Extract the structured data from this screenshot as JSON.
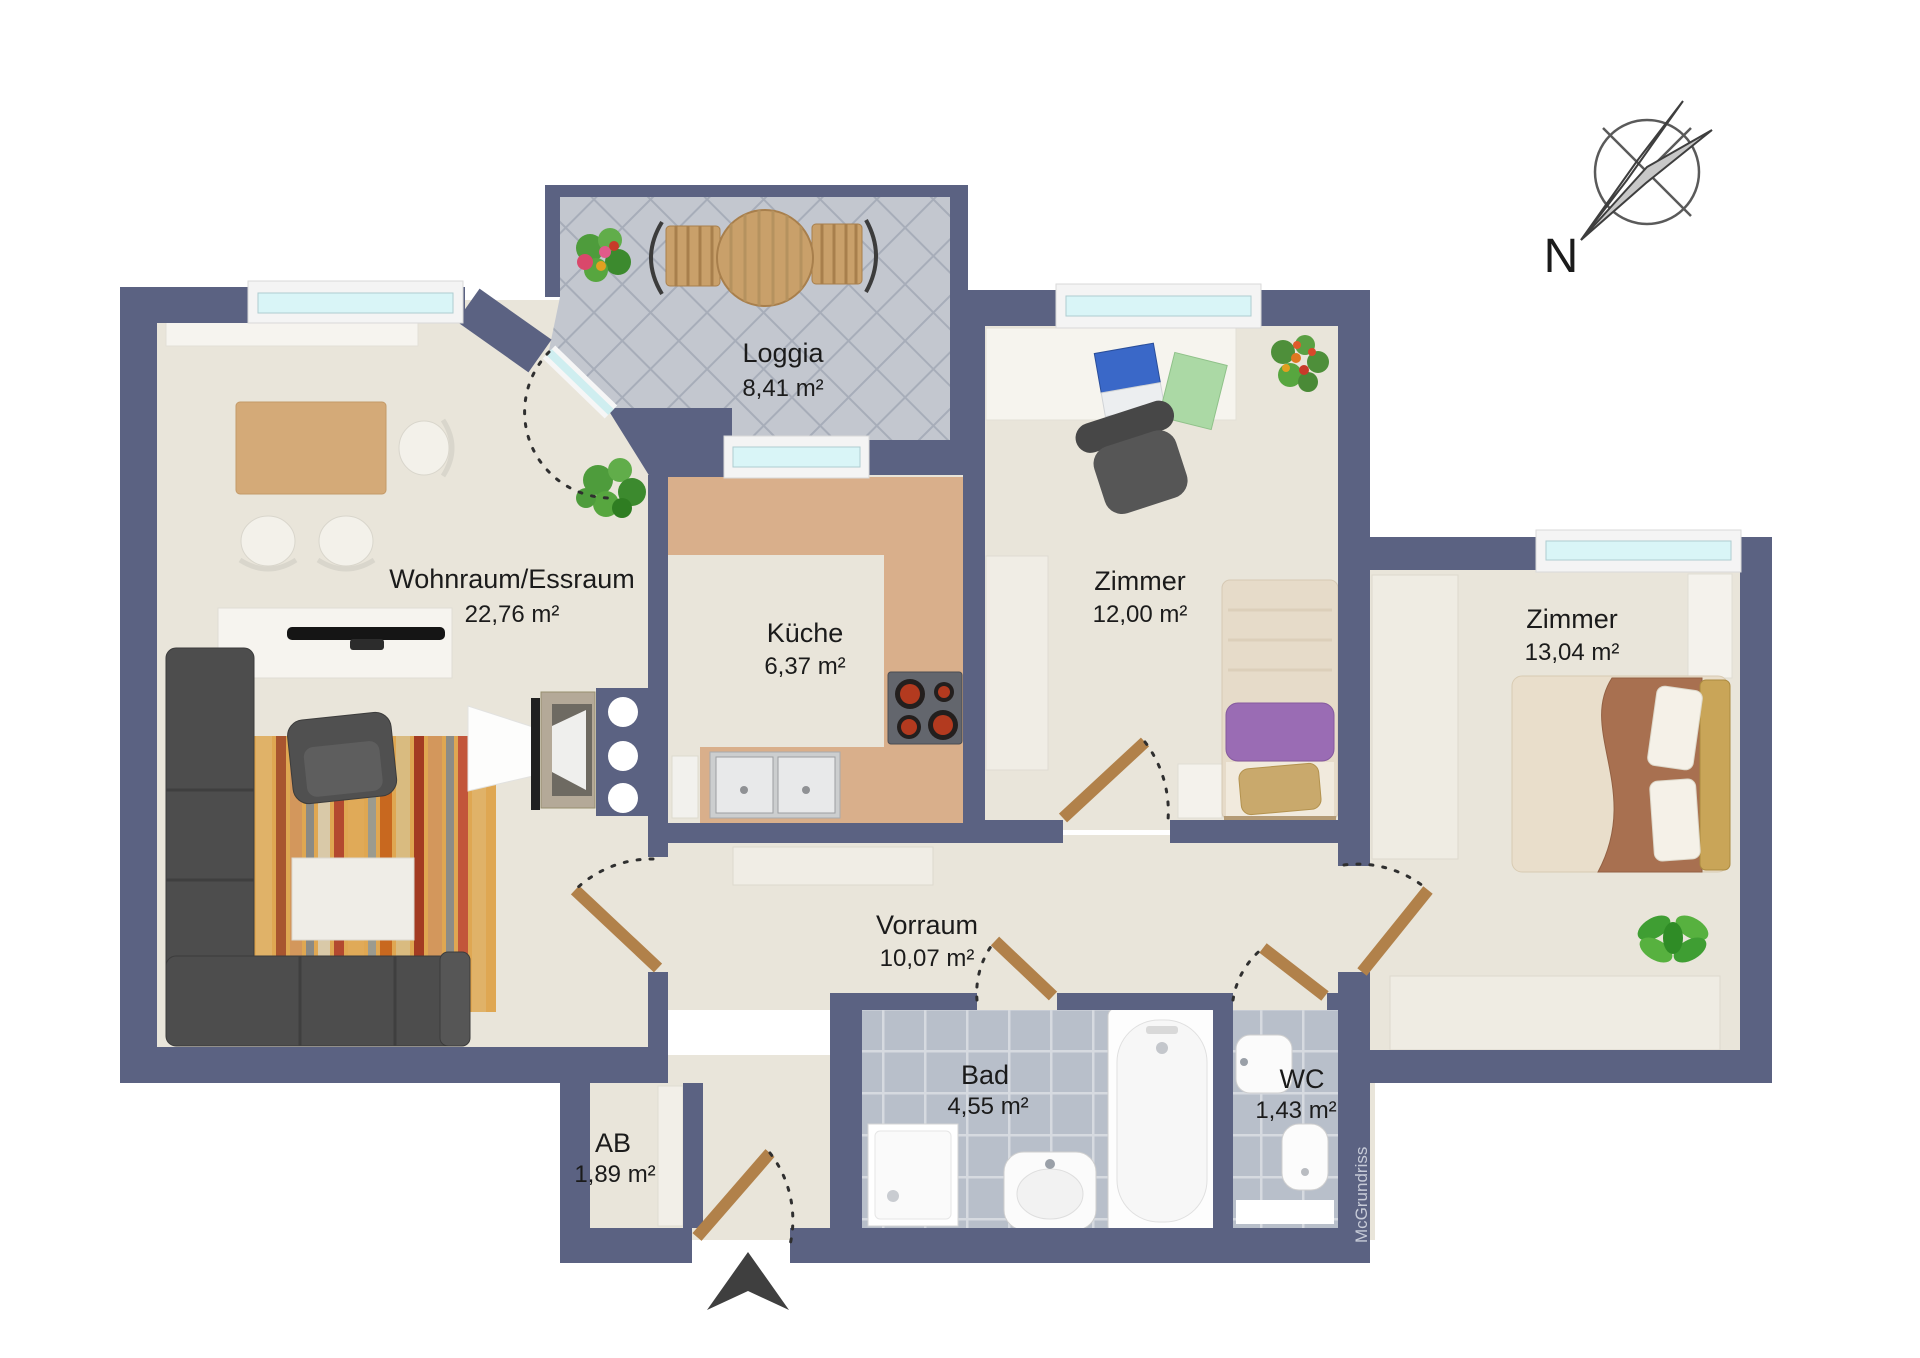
{
  "rooms": [
    {
      "name": "Loggia",
      "area": "8,41 m²"
    },
    {
      "name": "Wohnraum/Essraum",
      "area": "22,76 m²"
    },
    {
      "name": "Küche",
      "area": "6,37 m²"
    },
    {
      "name": "Zimmer",
      "area": "12,00 m²"
    },
    {
      "name": "Zimmer",
      "area": "13,04 m²"
    },
    {
      "name": "Vorraum",
      "area": "10,07 m²"
    },
    {
      "name": "Bad",
      "area": "4,55 m²"
    },
    {
      "name": "WC",
      "area": "1,43 m²"
    },
    {
      "name": "AB",
      "area": "1,89 m²"
    }
  ],
  "compass": {
    "north_label": "N"
  },
  "watermark": {
    "text": "McGrundriss"
  },
  "colors": {
    "wall": "#5b6282",
    "floor": "#e9e5da",
    "loggia_tile": "#c3c7cf",
    "loggia_grout": "#a7adb9",
    "bath_tile": "#b8bfca",
    "bath_grout": "#d6dae0",
    "counter": "#d9af8b",
    "window_glass": "#d9f5f7",
    "wood_door": "#b1814a"
  }
}
